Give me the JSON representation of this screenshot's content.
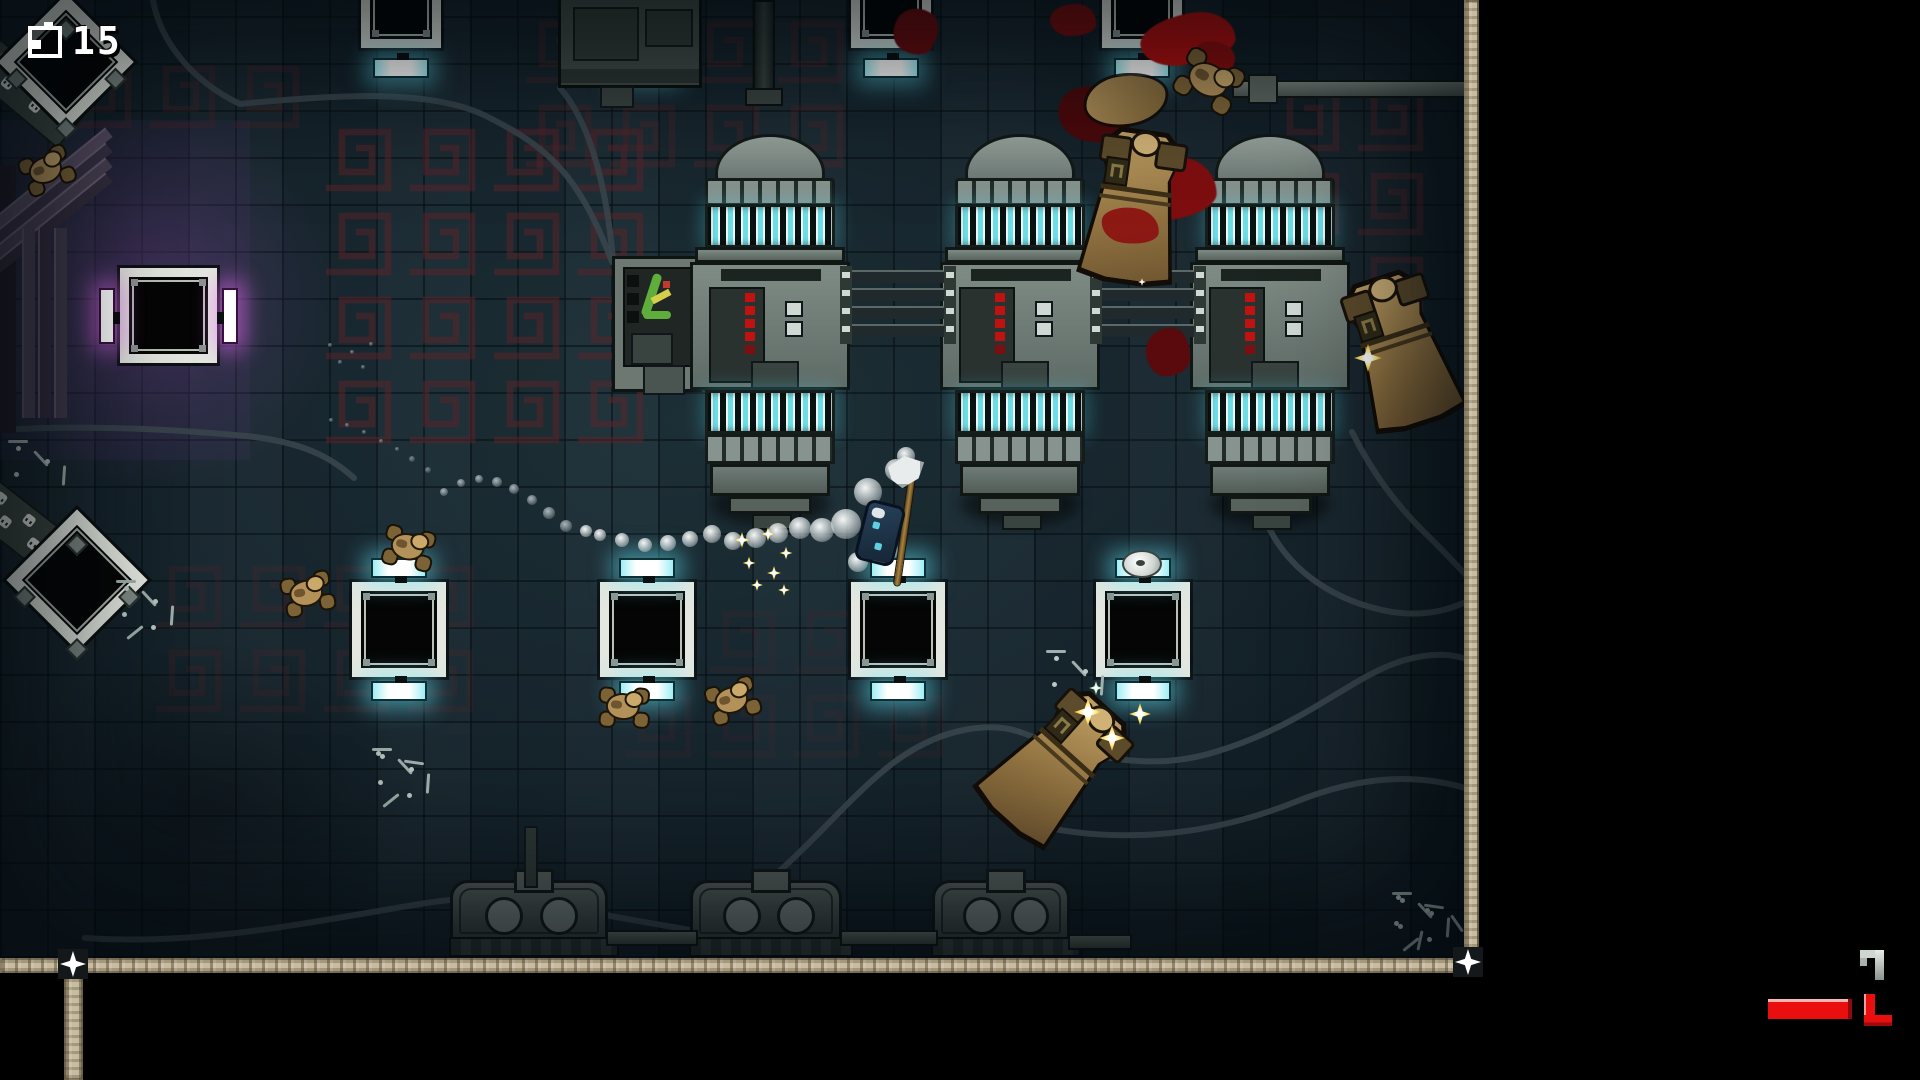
{
  "hud": {
    "counter_value": "15",
    "counter_icon": "charge-pack-icon",
    "health_color": "#e90f0f",
    "health_bar": {
      "x": 1768,
      "y": 999,
      "w": 80,
      "h": 20
    },
    "bracket_icon": "ammo-corner-icon",
    "hook_glyph": "map-fragment-glyph"
  },
  "scene": {
    "palette": {
      "floor": "#17262e",
      "floor_light": "#1d3038",
      "grout": "#060e12",
      "cyan_glow": "rgba(100,235,255,.5)",
      "magenta_glow": "rgba(235,110,250,.55)",
      "meander": "#5e2429",
      "cable": "#39454b",
      "machine": "#79857f",
      "tan": "#b3925a",
      "blood": "#7e0e10",
      "star_gold": "#ffe97a",
      "pad_frame": "#e3e7df"
    },
    "walls": {
      "bottom": {
        "x": 0,
        "y": 958,
        "w": 1479,
        "h": 15
      },
      "right": {
        "x": 1464,
        "y": 0,
        "w": 15,
        "h": 973
      },
      "stub_below": {
        "x": 64,
        "y": 971,
        "w": 19,
        "h": 109
      },
      "nodes": [
        {
          "x": 58,
          "y": 949
        },
        {
          "x": 1453,
          "y": 947
        }
      ]
    },
    "pads_top": [
      {
        "x": 361
      },
      {
        "x": 606
      },
      {
        "x": 851
      },
      {
        "x": 1102
      }
    ],
    "pads_mid": [
      {
        "x": 352,
        "y": 582
      },
      {
        "x": 600,
        "y": 582
      },
      {
        "x": 851,
        "y": 582
      },
      {
        "x": 1096,
        "y": 582,
        "item": true
      }
    ],
    "pad_purple": {
      "x": 120,
      "y": 268
    },
    "diamonds": [
      {
        "cx": 66,
        "cy": 62,
        "s": 96
      },
      {
        "cx": 77,
        "cy": 580,
        "s": 100
      }
    ],
    "machines": [
      {
        "cx": 770
      },
      {
        "cx": 1020
      },
      {
        "cx": 1270
      }
    ],
    "rails": [
      {
        "x": 848
      },
      {
        "x": 1098
      }
    ],
    "bottom_units": [
      {
        "x": 450,
        "w": 158
      },
      {
        "x": 690,
        "w": 152
      },
      {
        "x": 932,
        "w": 138
      }
    ],
    "meander_blocks": [
      {
        "x": 320,
        "y": 118,
        "w": 370,
        "h": 300,
        "op": 0.5
      },
      {
        "x": 520,
        "y": 10,
        "w": 340,
        "h": 170,
        "op": 0.3
      },
      {
        "x": 1268,
        "y": 78,
        "w": 200,
        "h": 210,
        "op": 0.38
      },
      {
        "x": 150,
        "y": 555,
        "w": 330,
        "h": 170,
        "op": 0.2
      },
      {
        "x": 620,
        "y": 600,
        "w": 340,
        "h": 170,
        "op": 0.14
      },
      {
        "x": 60,
        "y": 55,
        "w": 230,
        "h": 95,
        "op": 0.25
      }
    ],
    "cables": [
      "M153,0 C160,40 190,80 240,104 C330,95 430,88 486,116 C546,146 578,172 612,262",
      "M0,430 C90,424 180,430 246,436 C304,442 332,458 354,478",
      "M85,938 C200,946 310,922 420,904 C505,890 565,900 610,916 L690,930",
      "M700,928 C790,880 840,800 900,758 C945,727 990,722 1020,732",
      "M1020,732 C1090,758 1150,772 1215,752 C1310,723 1350,676 1405,660 C1442,650 1462,656 1478,664",
      "M1022,822 C1110,845 1205,838 1295,802 C1362,775 1420,772 1478,792",
      "M1270,530 C1292,572 1335,602 1392,612 C1434,618 1458,606 1478,596",
      "M1352,432 C1372,472 1394,502 1424,532 C1447,554 1463,572 1478,588",
      "M560,88 C588,120 606,180 613,260"
    ],
    "blood": [
      {
        "x": 1140,
        "y": 14,
        "w": 95,
        "h": 50,
        "c": "#b30f0f",
        "r": -10
      },
      {
        "x": 1196,
        "y": 42,
        "w": 40,
        "h": 26,
        "c": "#8c0c0c",
        "r": 20
      },
      {
        "x": 1050,
        "y": 4,
        "w": 46,
        "h": 32,
        "c": "#7a0d0d",
        "r": 0
      },
      {
        "x": 1058,
        "y": 86,
        "w": 72,
        "h": 56,
        "c": "#4a090b",
        "r": 12
      },
      {
        "x": 1118,
        "y": 158,
        "w": 98,
        "h": 62,
        "c": "#7e0e10",
        "r": -6
      },
      {
        "x": 1146,
        "y": 328,
        "w": 44,
        "h": 48,
        "c": "#5a0a0c",
        "r": 0
      },
      {
        "x": 894,
        "y": 8,
        "w": 44,
        "h": 46,
        "c": "#6b0c0e",
        "r": 30
      }
    ],
    "small_zombies": [
      {
        "x": 20,
        "y": 148,
        "r": -20
      },
      {
        "x": 383,
        "y": 524,
        "r": 15
      },
      {
        "x": 281,
        "y": 571,
        "r": -10
      },
      {
        "x": 598,
        "y": 684,
        "r": 5
      },
      {
        "x": 706,
        "y": 678,
        "r": -15
      },
      {
        "x": 1178,
        "y": 52,
        "r": 30,
        "big": true
      }
    ],
    "big_zombies": [
      {
        "x": 1082,
        "y": 132,
        "r": 8,
        "blood": true,
        "emblem": true
      },
      {
        "x": 1348,
        "y": 276,
        "r": -18,
        "emblem": true
      },
      {
        "x": 1004,
        "y": 690,
        "r": 42,
        "emblem": true
      }
    ],
    "dead_blob": {
      "x": 1086,
      "y": 76,
      "w": 80,
      "h": 48,
      "r": -8
    },
    "skeletons": [
      {
        "x": 1392,
        "y": 892,
        "n": 7
      },
      {
        "x": 1046,
        "y": 650,
        "n": 4
      },
      {
        "x": 372,
        "y": 748,
        "n": 5
      },
      {
        "x": 116,
        "y": 580,
        "n": 4
      },
      {
        "x": 8,
        "y": 440,
        "n": 3
      }
    ],
    "puffs_white": [
      [
        906,
        456,
        9
      ],
      [
        868,
        492,
        14
      ],
      [
        896,
        470,
        11
      ],
      [
        886,
        550,
        12
      ],
      [
        858,
        562,
        10
      ],
      [
        846,
        524,
        15
      ],
      [
        822,
        530,
        12
      ],
      [
        800,
        528,
        11
      ],
      [
        778,
        533,
        10
      ],
      [
        756,
        538,
        10
      ],
      [
        733,
        541,
        9
      ],
      [
        712,
        534,
        9
      ],
      [
        690,
        539,
        8
      ],
      [
        668,
        543,
        8
      ],
      [
        645,
        545,
        7
      ],
      [
        622,
        540,
        7
      ],
      [
        600,
        535,
        6
      ],
      [
        586,
        531,
        6
      ]
    ],
    "puffs_gray": [
      [
        566,
        526,
        6
      ],
      [
        549,
        513,
        6
      ],
      [
        532,
        500,
        5
      ],
      [
        514,
        489,
        5
      ],
      [
        497,
        482,
        5
      ],
      [
        479,
        479,
        4
      ],
      [
        461,
        483,
        4
      ],
      [
        444,
        492,
        4
      ]
    ],
    "puffs_speck": [
      [
        428,
        470,
        3
      ],
      [
        412,
        459,
        3
      ],
      [
        397,
        449,
        2
      ],
      [
        381,
        441,
        2
      ],
      [
        364,
        432,
        2
      ],
      [
        347,
        425,
        2
      ],
      [
        331,
        420,
        2
      ],
      [
        352,
        352,
        2
      ],
      [
        340,
        362,
        2
      ],
      [
        363,
        367,
        2
      ],
      [
        330,
        345,
        2
      ],
      [
        371,
        344,
        2
      ]
    ],
    "stars": [
      {
        "x": 742,
        "y": 540,
        "s": 16
      },
      {
        "x": 768,
        "y": 534,
        "s": 14
      },
      {
        "x": 786,
        "y": 553,
        "s": 13
      },
      {
        "x": 749,
        "y": 563,
        "s": 13
      },
      {
        "x": 774,
        "y": 573,
        "s": 14
      },
      {
        "x": 757,
        "y": 585,
        "s": 12
      },
      {
        "x": 784,
        "y": 590,
        "s": 12
      },
      {
        "x": 1088,
        "y": 712,
        "s": 28
      },
      {
        "x": 1140,
        "y": 714,
        "s": 22
      },
      {
        "x": 1112,
        "y": 738,
        "s": 26
      },
      {
        "x": 1368,
        "y": 358,
        "s": 28
      },
      {
        "x": 1096,
        "y": 688,
        "s": 14,
        "c": "#aef2b6"
      },
      {
        "x": 1142,
        "y": 282,
        "s": 8,
        "c": "#ffd5ee"
      }
    ],
    "player": {
      "x": 858,
      "y": 496,
      "rot": 14
    }
  }
}
